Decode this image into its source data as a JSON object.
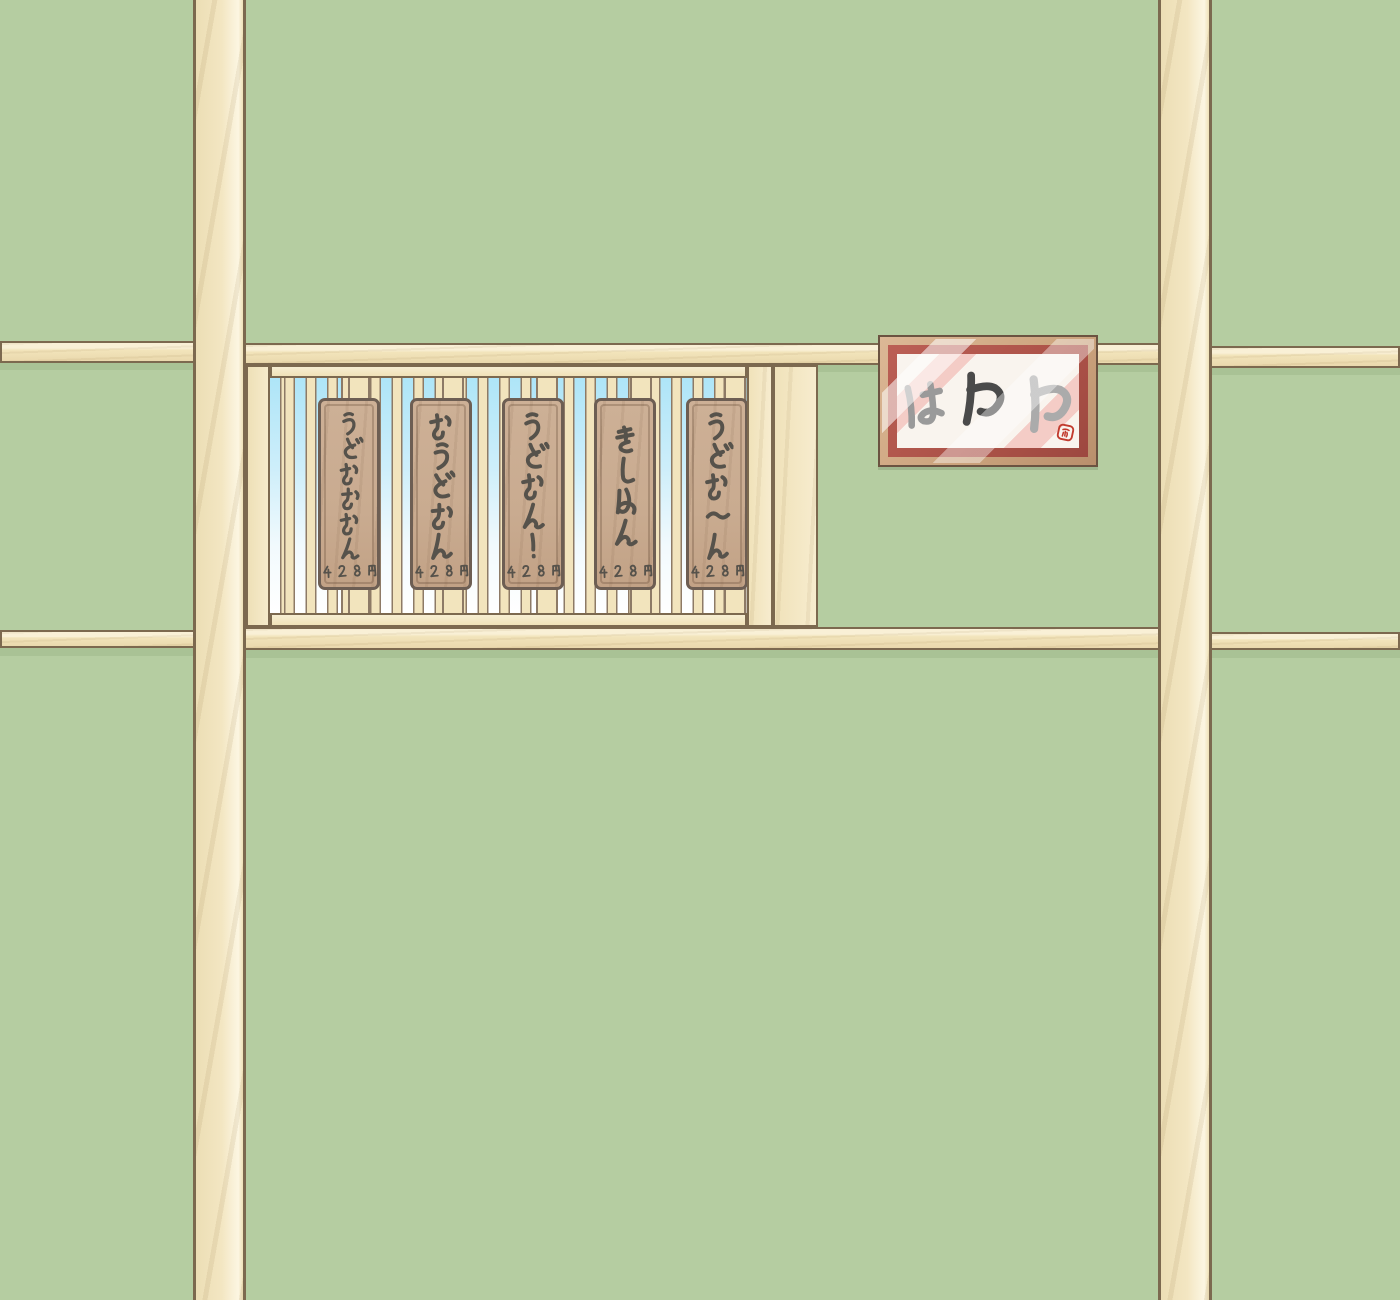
{
  "menu_board": {
    "items": [
      {
        "name": "うどおおおん",
        "price": "428円"
      },
      {
        "name": "おうどおん",
        "price": "428円"
      },
      {
        "name": "うどおん!",
        "price": "428円"
      },
      {
        "name": "きしめん",
        "price": "428円"
      },
      {
        "name": "うどお〜ん",
        "price": "428円"
      }
    ]
  },
  "sign": {
    "text": "はわわ",
    "calligraphy_colors": [
      "#9a9a9a",
      "#4a4a4a",
      "#ababab"
    ],
    "seal_color": "#c23b2e"
  },
  "colors": {
    "wall_green": "#b5cda1",
    "wall_shadow_green": "#a9c295",
    "wood_cream": "#f2e4bb",
    "wood_outline": "#7c694f",
    "sky_top": "#aee5f8",
    "sky_bottom": "#ffffff",
    "plaque_wood": "#c9ab90",
    "plaque_text": "#56524b",
    "sign_frame_tan": "#cda57f",
    "sign_mat_red": "#ac5248",
    "paper_white": "#f9f4ee",
    "paper_stripe_pink": "#f4ccc6"
  }
}
